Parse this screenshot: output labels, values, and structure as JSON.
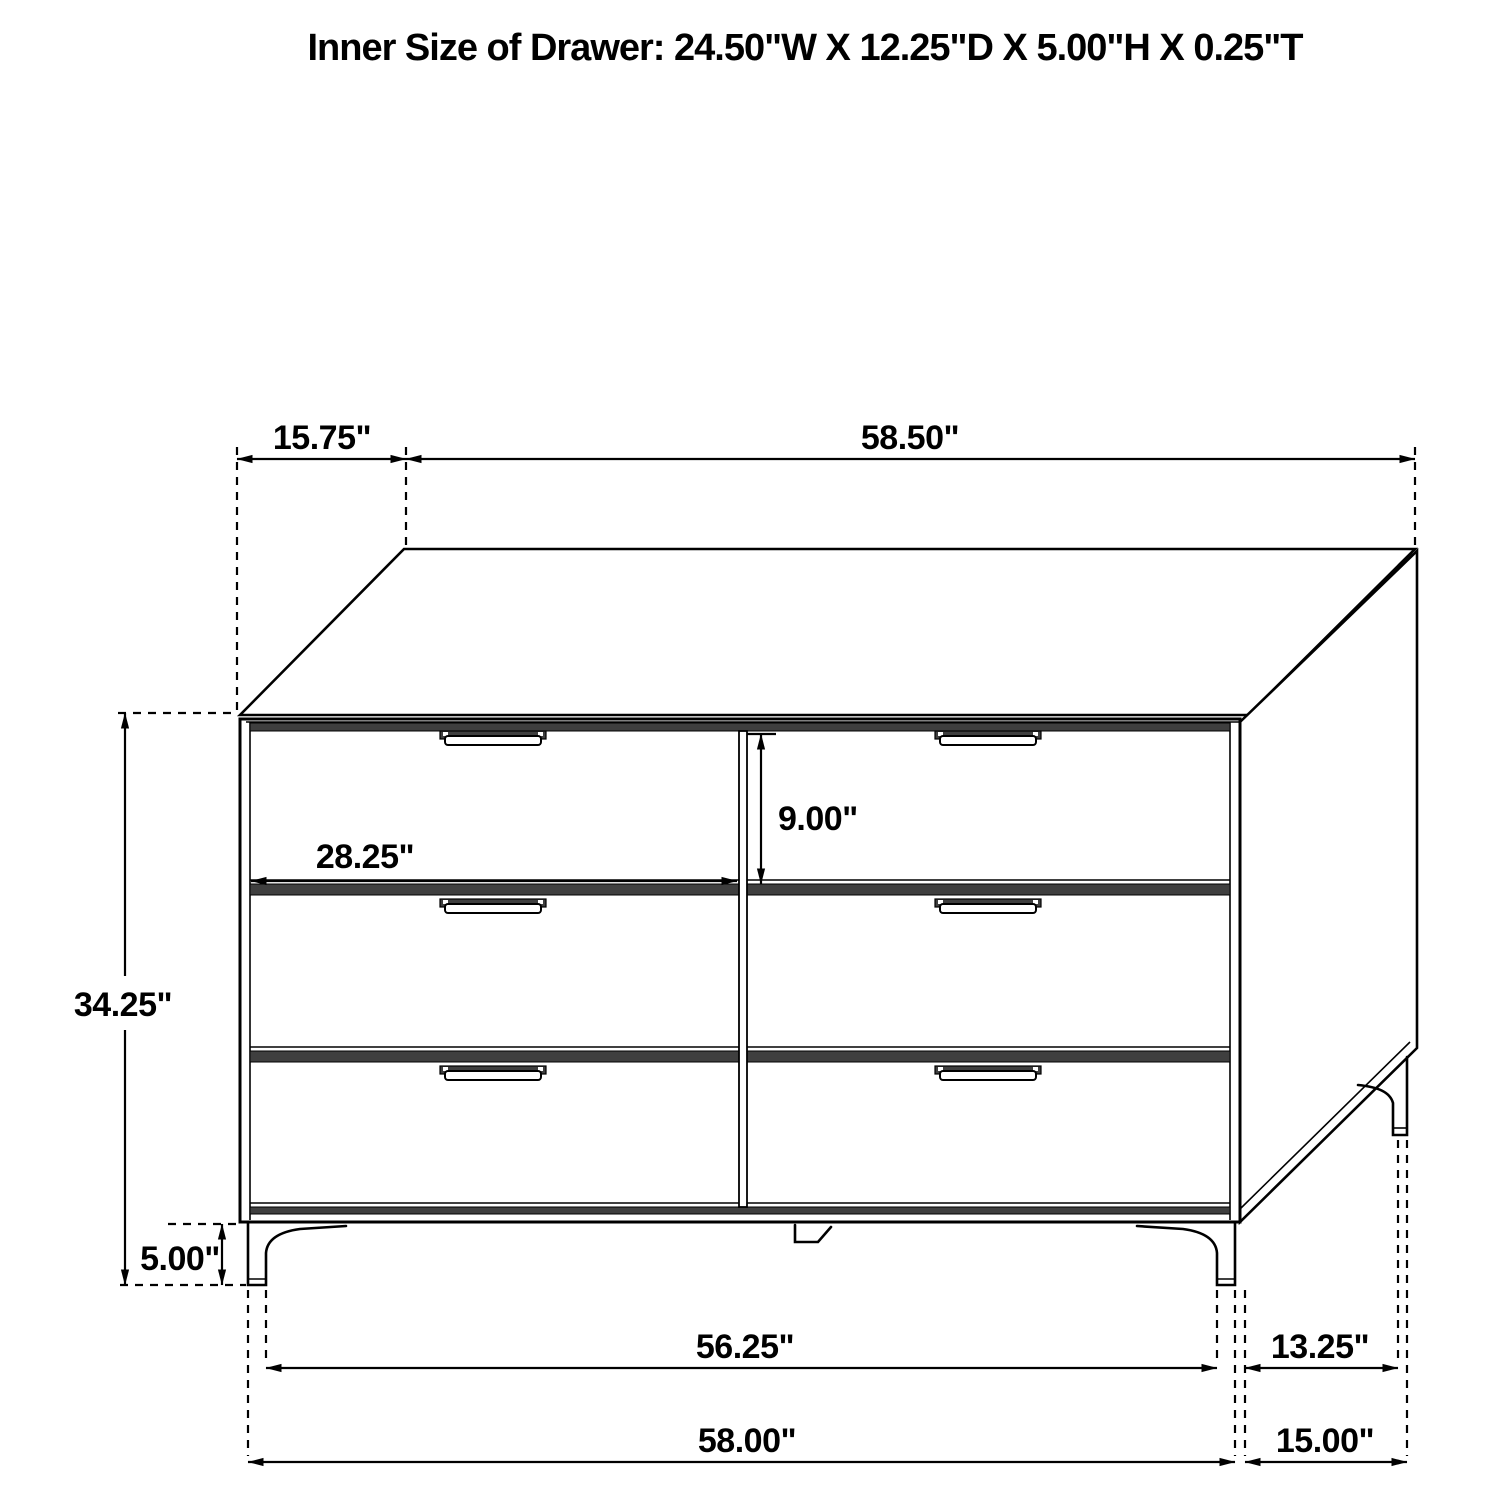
{
  "title": "Inner Size of Drawer: 24.50\"W X 12.25\"D X 5.00\"H X 0.25\"T",
  "dimensions": {
    "top_depth_offset": "15.75\"",
    "top_width": "58.50\"",
    "drawer_front_height": "9.00\"",
    "drawer_front_width": "28.25\"",
    "cabinet_height": "34.25\"",
    "leg_height": "5.00\"",
    "front_width_between_legs": "56.25\"",
    "side_depth_between_legs": "13.25\"",
    "front_overall_width": "58.00\"",
    "side_overall_depth": "15.00\""
  },
  "colors": {
    "line": "#000000",
    "shade_band": "#3f3f3f",
    "background": "#ffffff"
  }
}
